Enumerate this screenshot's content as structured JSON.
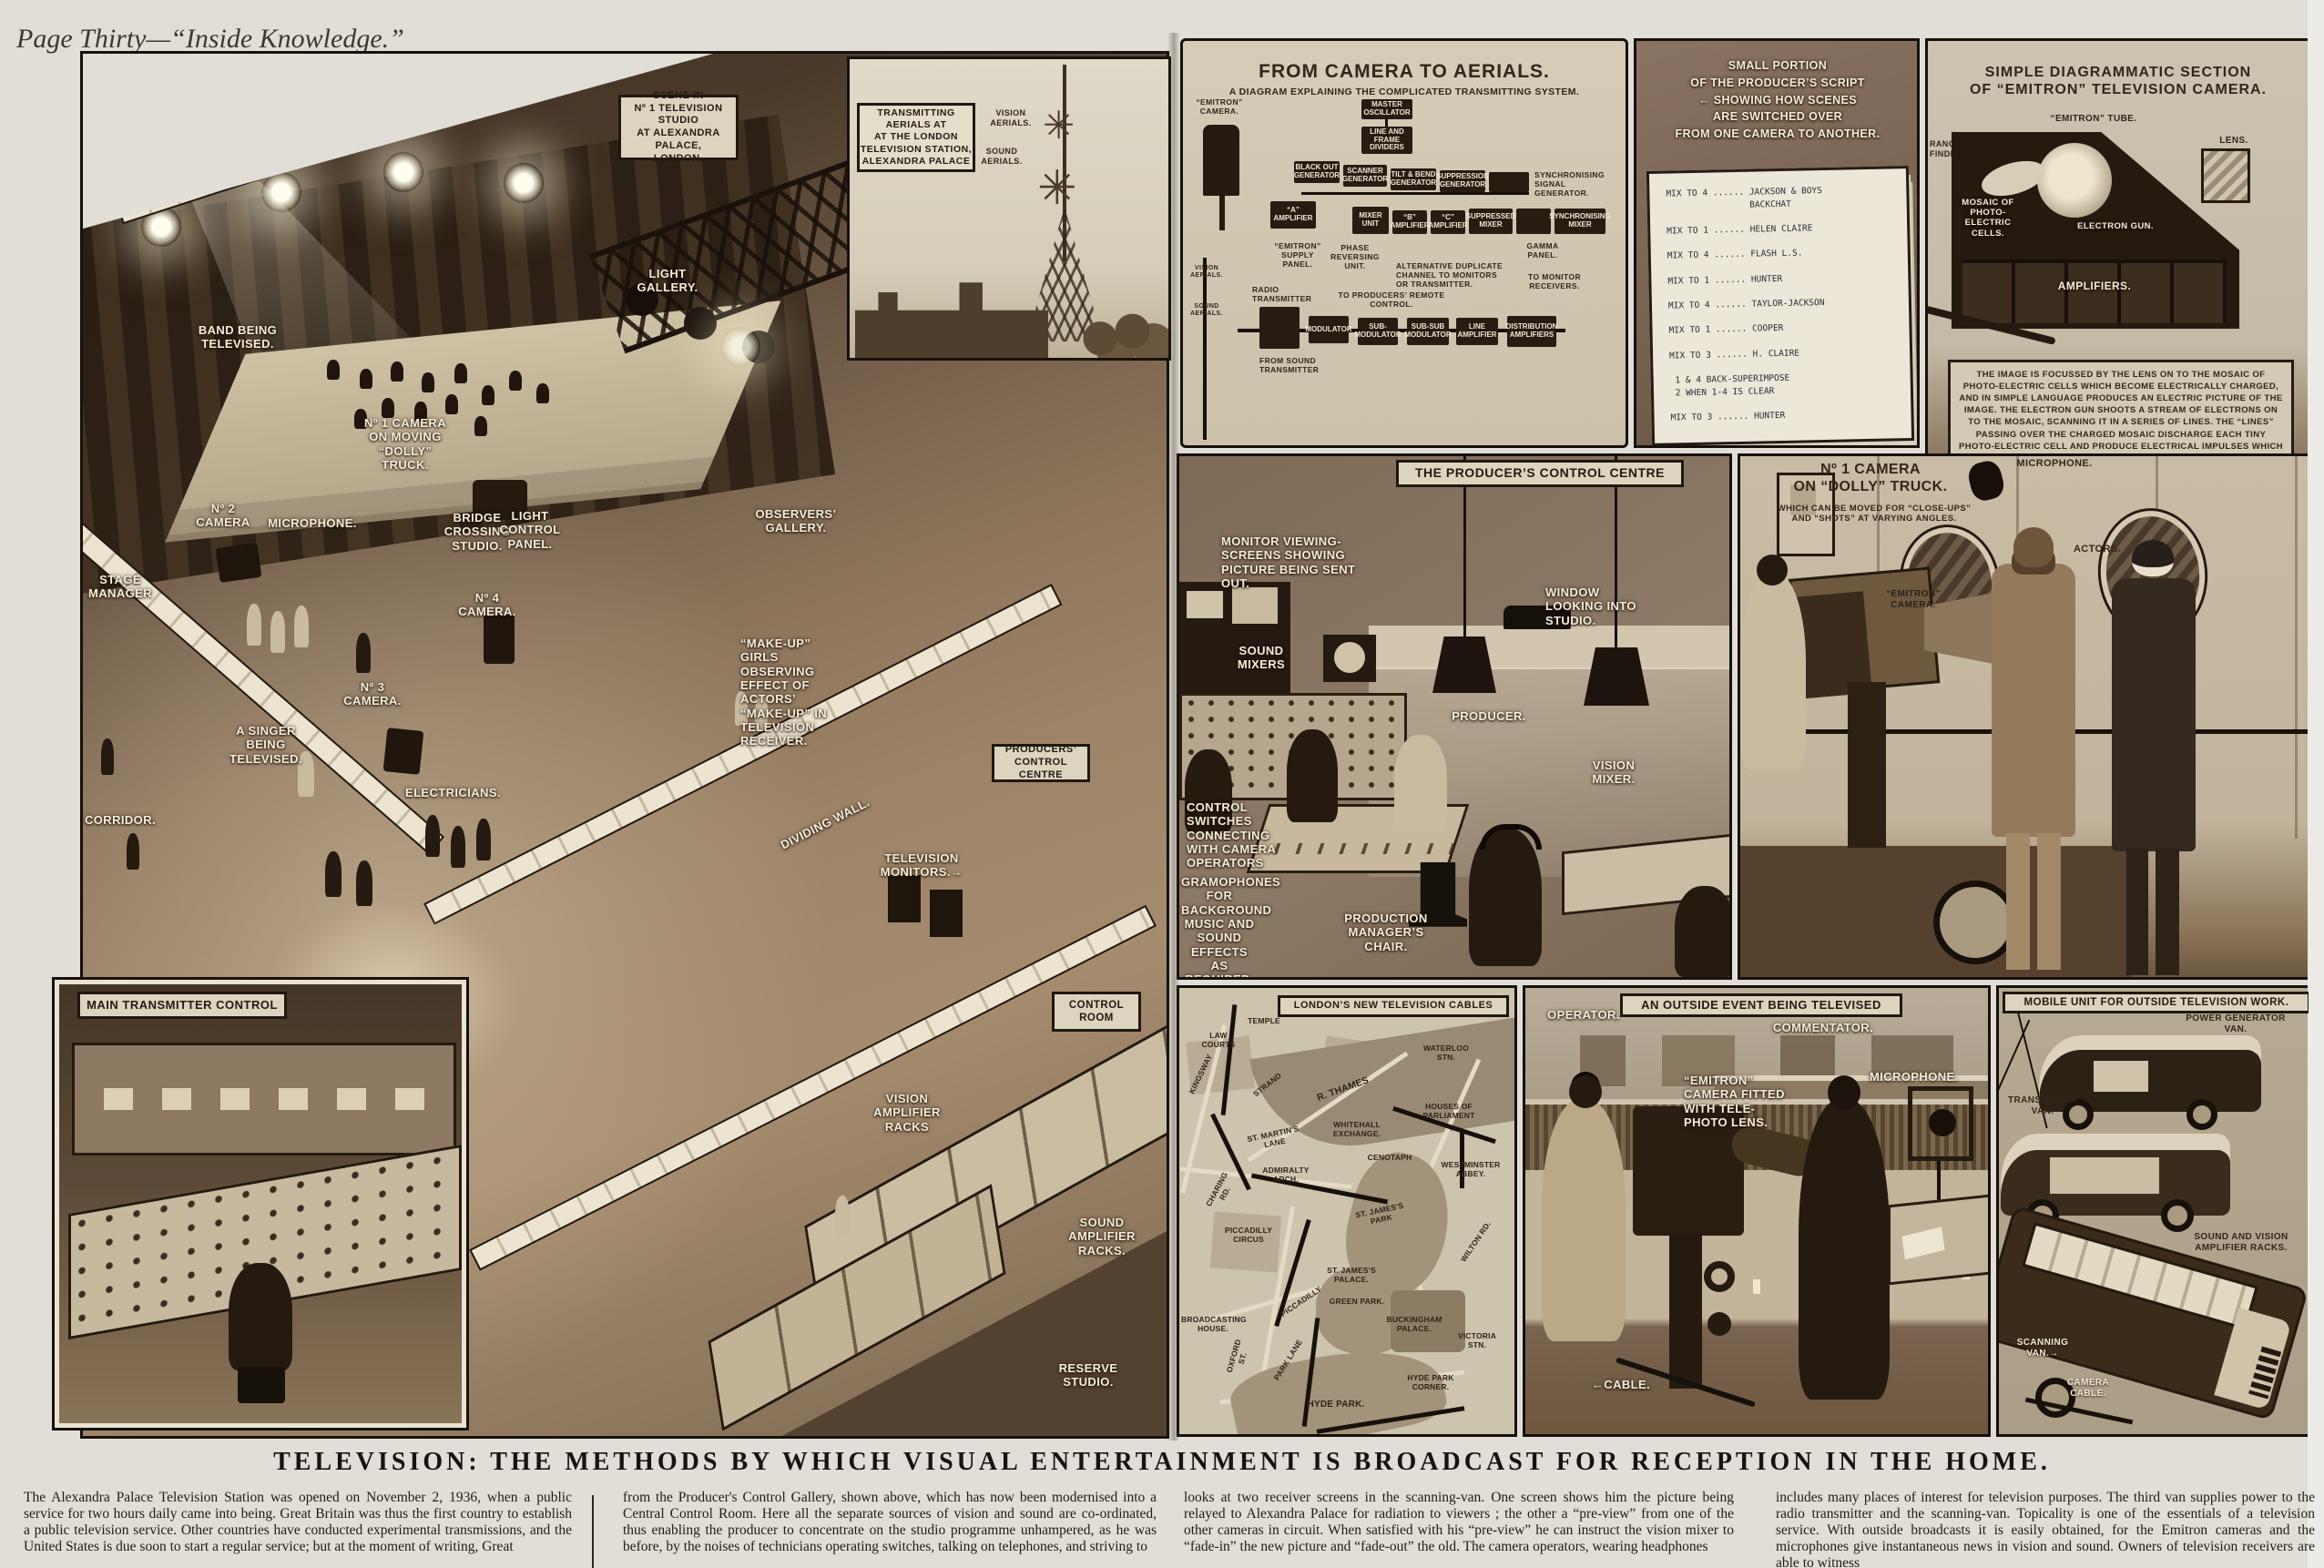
{
  "palette": {
    "page_bg": "#e0ded7",
    "ink": "#1c1610",
    "sepia_dark": "#3a2c1f",
    "sepia_mid": "#8a7560",
    "sepia_light": "#cfc4ad",
    "label_white": "#f4edd9"
  },
  "page": {
    "header": "Page Thirty—“Inside Knowledge.”",
    "headline": "TELEVISION:  THE  METHODS  BY  WHICH  VISUAL  ENTERTAINMENT  IS  BROADCAST  FOR  RECEPTION  IN  THE  HOME.",
    "signature": "G·H·DAVIS",
    "article": {
      "col1": "The Alexandra Palace Television Station was opened on November 2, 1936, when a public service for two hours daily came into being. Great Britain was thus the first country to establish a public television service. Other countries have conducted experimental transmissions, and the United States is due soon to start a regular service; but at the moment of writing, Great",
      "col2": "from the Producer's Control Gallery, shown above, which has now been modernised into a Central Control Room. Here all the separate sources of vision and sound are co-ordinated, thus enabling the producer to concentrate on the studio programme unhampered, as he was before, by the noises of technicians operating switches, talking on telephones, and striving to",
      "col3": "looks at two receiver screens in the scanning-van. One screen shows him the picture being relayed to Alexandra Palace for radiation to viewers ; the other a “pre-view” from one of the other cameras in circuit. When satisfied with his “pre-view” he can instruct the vision mixer to “fade-in” the new picture and “fade-out” the old. The camera operators, wearing headphones",
      "col4": "includes many places of interest for television purposes. The third van supplies power to the radio transmitter and the scanning-van. Topicality is one of the essentials of a television service. With outside broadcasts it is easily obtained, for the Emitron cameras and the microphones give instantaneous news in vision and sound. Owners of television receivers are able to witness"
    }
  },
  "studio": {
    "title": "SCENE IN\nNº 1 TELEVISION STUDIO\nAT ALEXANDRA PALACE,\nLONDON.",
    "labels": {
      "band": "BAND BEING TELEVISED.",
      "light_gallery": "LIGHT GALLERY.",
      "no2_camera": "Nº 2 CAMERA",
      "microphone": "MICROPHONE.",
      "no1_camera": "Nº 1 CAMERA ON MOVING “DOLLY” TRUCK.",
      "bridge": "BRIDGE CROSSING STUDIO.",
      "light_control": "LIGHT CONTROL PANEL.",
      "observers": "OBSERVERS’ GALLERY.",
      "stage_manager": "STAGE MANAGER",
      "no4_camera": "Nº 4 CAMERA.",
      "singer": "A SINGER BEING TELEVISED.",
      "no3_camera": "Nº 3 CAMERA.",
      "makeup": "“MAKE-UP” GIRLS OBSERVING EFFECT OF ACTORS’ “MAKE-UP” IN TELEVISION RECEIVER.",
      "electricians": "ELECTRICIANS.",
      "corridor": "CORRIDOR.",
      "dividing_wall": "DIVIDING WALL.",
      "tv_monitors": "TELEVISION MONITORS.→",
      "vision_racks": "VISION AMPLIFIER RACKS",
      "sound_racks": "SOUND AMPLIFIER RACKS.",
      "reserve": "RESERVE STUDIO."
    },
    "boxes": {
      "producers": "PRODUCERS’ CONTROL CENTRE",
      "control_room": "CONTROL ROOM",
      "main_transmitter": "MAIN TRANSMITTER CONTROL"
    }
  },
  "aerials": {
    "title": "TRANSMITTING\nAERIALS AT\nAT THE LONDON\nTELEVISION STATION,\nALEXANDRA PALACE",
    "vision": "VISION AERIALS.",
    "sound": "SOUND AERIALS."
  },
  "flow": {
    "title": "FROM CAMERA TO AERIALS.",
    "subtitle": "A DIAGRAM EXPLAINING THE COMPLICATED TRANSMITTING SYSTEM.",
    "blocks": {
      "master": "MASTER OSCILLATOR",
      "dividers": "LINE AND FRAME DIVIDERS",
      "blackout": "BLACK OUT GENERATOR",
      "scanner": "SCANNER GENERATOR",
      "tilt": "TILT & BEND GENERATOR",
      "suppression": "SUPPRESSION GENERATOR",
      "amp_a": "“A” AMPLIFIER",
      "mixer_unit": "MIXER UNIT",
      "amp_b": "“B” AMPLIFIER",
      "amp_c": "“C” AMPLIFIER",
      "suppressed_mixer": "SUPPRESSED MIXER",
      "sync_mixer": "SYNCHRONISING MIXER",
      "modulator": "MODULATOR",
      "sub_mod": "SUB-MODULATOR",
      "subsub_mod": "SUB-SUB MODULATOR",
      "line_amp": "LINE AMPLIFIER",
      "dist_amp": "DISTRIBUTION AMPLIFIERS"
    },
    "notes": {
      "camera": "“EMITRON” CAMERA.",
      "supply": "“EMITRON” SUPPLY PANEL.",
      "phase": "PHASE REVERSING UNIT.",
      "sync_gen": "SYNCHRONISING SIGNAL GENERATOR.",
      "gamma": "GAMMA PANEL.",
      "alt": "ALTERNATIVE DUPLICATE CHANNEL TO MONITORS OR TRANSMITTER.",
      "remote": "TO PRODUCERS’ REMOTE CONTROL.",
      "monitors": "TO MONITOR RECEIVERS.",
      "radio_tx": "RADIO TRANSMITTER",
      "from_sound": "FROM SOUND TRANSMITTER",
      "vision_aerials": "VISION AERIALS.",
      "sound_aerials": "SOUND AERIALS."
    }
  },
  "script": {
    "title": "SMALL PORTION\nOF THE PRODUCER’S SCRIPT\n← SHOWING HOW SCENES\nARE SWITCHED OVER\nFROM ONE CAMERA TO ANOTHER.",
    "body": "MIX TO 4 ...... JACKSON & BOYS\n                BACKCHAT\n\nMIX TO 1 ...... HELEN CLAIRE\n\nMIX TO 4 ...... FLASH L.S.\n\nMIX TO 1 ...... HUNTER\n\nMIX TO 4 ...... TAYLOR-JACKSON\n\nMIX TO 1 ...... COOPER\n\nMIX TO 3 ...... H. CLAIRE\n\n 1 & 4 BACK-SUPERIMPOSE\n 2 WHEN 1-4 IS CLEAR\n\nMIX TO 3 ...... HUNTER"
  },
  "emitron": {
    "title": "SIMPLE DIAGRAMMATIC SECTION\nOF “EMITRON” TELEVISION CAMERA.",
    "labels": {
      "tube": "“EMITRON” TUBE.",
      "lens": "LENS.",
      "range": "RANGE FINDER.",
      "mosaic": "MOSAIC OF PHOTO-ELECTRIC CELLS.",
      "gun": "ELECTRON GUN.",
      "amplifiers": "AMPLIFIERS."
    },
    "caption": "THE IMAGE IS FOCUSSED BY THE LENS ON TO THE MOSAIC OF PHOTO-ELECTRIC CELLS WHICH BECOME ELECTRICALLY CHARGED, AND IN SIMPLE LANGUAGE PRODUCES AN ELECTRIC PICTURE OF THE IMAGE. THE ELECTRON GUN SHOOTS A STREAM OF ELECTRONS ON TO THE MOSAIC, SCANNING IT IN A SERIES OF LINES. THE “LINES” PASSING OVER THE CHARGED MOSAIC DISCHARGE EACH TINY PHOTO-ELECTRIC CELL AND PRODUCE ELECTRICAL IMPULSES WHICH MAKE UP THE VISION SIGNAL. THIS IS AMPLIFIED AND SENT ON TO THE CONTROL ROOM BY CABLE."
  },
  "producer": {
    "title": "THE PRODUCER’S CONTROL CENTRE",
    "labels": {
      "monitors": "MONITOR VIEWING-SCREENS SHOWING PICTURE BEING SENT OUT.",
      "sound_mixers": "SOUND MIXERS",
      "window": "WINDOW LOOKING INTO STUDIO.",
      "producer": "PRODUCER.",
      "vision_mixer": "VISION MIXER.",
      "switches": "CONTROL SWITCHES CONNECTING WITH CAMERA OPERATORS",
      "gramophones": "GRAMOPHONES FOR BACKGROUND MUSIC AND SOUND EFFECTS AS REQUIRED.",
      "chair": "PRODUCTION MANAGER’S CHAIR."
    }
  },
  "dolly": {
    "title": "Nº 1 CAMERA\nON “DOLLY” TRUCK.",
    "subtitle": "WHICH CAN BE MOVED FOR “CLOSE-UPS”\nAND “SHOTS” AT VARYING ANGLES.",
    "labels": {
      "microphone": "MICROPHONE.",
      "camera": "“EMITRON”\nCAMERA.",
      "actors": "ACTORS."
    }
  },
  "map": {
    "title": "LONDON’S NEW TELEVISION CABLES",
    "labels": {
      "law_courts": "LAW COURTS",
      "temple": "TEMPLE",
      "kingsway": "KINGSWAY",
      "strand": "STRAND",
      "thames": "R. THAMES",
      "waterloo": "WATERLOO STN.",
      "parliament": "HOUSES OF PARLIAMENT",
      "whitehall": "WHITEHALL EXCHANGE.",
      "st_martins": "ST. MARTIN'S LANE",
      "cenotaph": "CENOTAPH",
      "westminster": "WESTMINSTER ABBEY.",
      "admiralty": "ADMIRALTY ARCH.",
      "charing": "CHARING RD.",
      "piccadilly_circus": "PICCADILLY CIRCUS",
      "st_james_park": "ST. JAMES'S PARK",
      "wilton": "WILTON RD.",
      "st_james_palace": "ST. JAMES'S PALACE.",
      "green_park": "GREEN PARK.",
      "buckingham": "BUCKINGHAM PALACE.",
      "victoria": "VICTORIA STN.",
      "broadcasting": "BROADCASTING HOUSE.",
      "hyde_corner": "HYDE PARK CORNER.",
      "hyde_park": "HYDE PARK.",
      "piccadilly": "PICCADILLY",
      "park_lane": "PARK LANE",
      "oxford": "OXFORD ST."
    }
  },
  "outside": {
    "title": "AN OUTSIDE EVENT BEING TELEVISED",
    "labels": {
      "operator": "OPERATOR.",
      "commentator": "COMMENTATOR.",
      "camera": "“EMITRON” CAMERA FITTED WITH TELE-PHOTO LENS.",
      "microphone": "MICROPHONE.",
      "cable": "←CABLE."
    }
  },
  "mobile": {
    "title": "MOBILE UNIT FOR OUTSIDE TELEVISION WORK.",
    "labels": {
      "power": "POWER GENERATOR VAN.",
      "transmitter": "TRANSMITTER VAN.",
      "racks": "SOUND AND VISION AMPLIFIER RACKS.",
      "scanning": "SCANNING VAN.→",
      "cable": "CAMERA CABLE."
    }
  }
}
